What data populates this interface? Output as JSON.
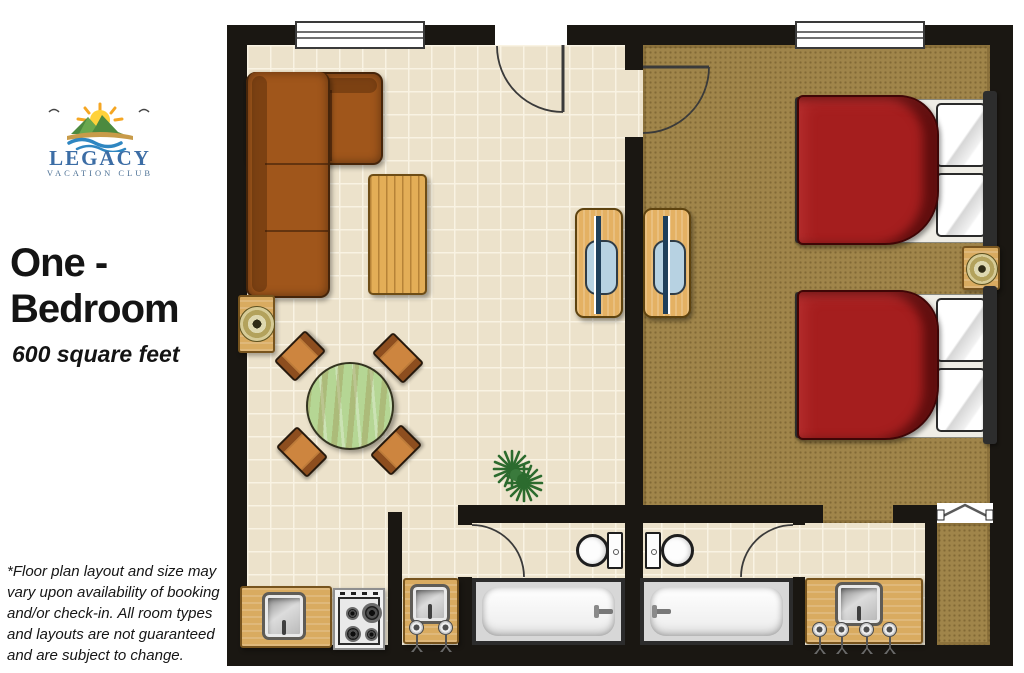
{
  "sidebar": {
    "logo": {
      "brand": "LEGACY",
      "subtitle": "VACATION CLUB",
      "icon": "legacy-vacation-club-sun-logo"
    },
    "room_title_line1": "One -",
    "room_title_line2": "Bedroom",
    "room_size": "600 square feet",
    "disclaimer": "*Floor plan layout and size may vary upon availability of booking and/or check-in. All room types and layouts are not guaranteed and are subject to change."
  },
  "floorplan": {
    "rooms": [
      "living-room",
      "kitchen",
      "dining-area",
      "bedroom",
      "bathroom-1",
      "bathroom-2",
      "vanity-nook-1",
      "vanity-nook-2",
      "closet"
    ],
    "furniture": [
      "sectional-sofa",
      "coffee-table",
      "end-table-with-lamp",
      "round-dining-table-4-chairs",
      "tv-stand-living",
      "tv-stand-bedroom",
      "double-bed-1",
      "double-bed-2",
      "nightstand-with-lamp",
      "potted-plant",
      "kitchen-sink-counter",
      "stove-cooktop",
      "vanity-sink-1",
      "vanity-sink-2",
      "toilet-1",
      "toilet-2",
      "bathtub-1",
      "bathtub-2"
    ],
    "doors": [
      "entry-door",
      "bedroom-door",
      "bathroom-1-door",
      "bathroom-2-door",
      "closet-bifold-door"
    ],
    "windows": [
      "living-room-window",
      "bedroom-window"
    ]
  },
  "colors": {
    "wall": "#1a1712",
    "tile": "#ece2cb",
    "tileLine": "#f9f3e3",
    "carpet": "#a0854a",
    "wood": "#d9ab60",
    "woodDark": "#77541e",
    "sofa": "#a0561b",
    "bedRed": "#a51e1e",
    "tableGreen": "#b5d694",
    "tvBlue": "#b7d2e2",
    "logoBlue": "#3c6da5"
  }
}
